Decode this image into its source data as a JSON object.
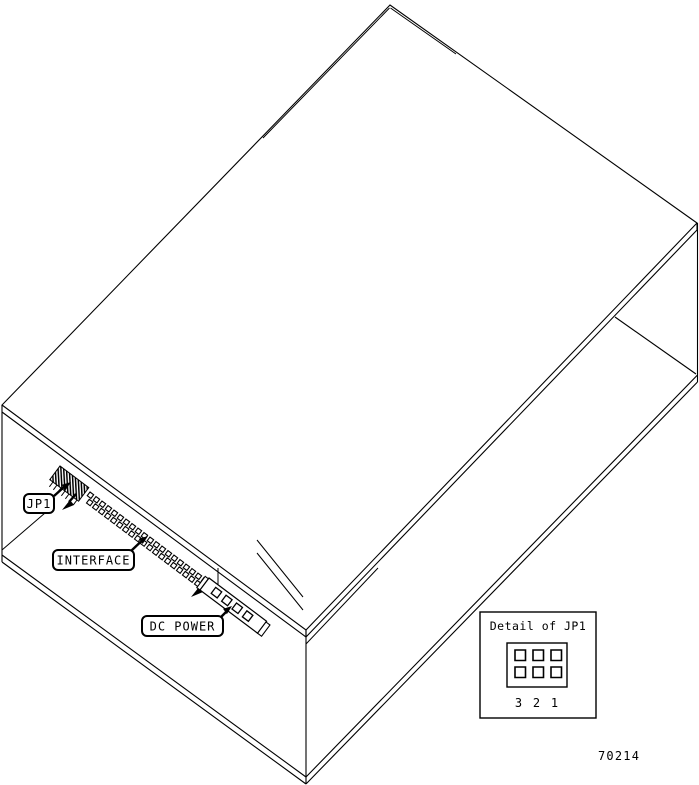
{
  "figure": {
    "callouts": [
      {
        "id": "jp1",
        "label": "JP1"
      },
      {
        "id": "interface",
        "label": "INTERFACE"
      },
      {
        "id": "dc_power",
        "label": "DC POWER"
      }
    ],
    "detail_box": {
      "title": "Detail of JP1",
      "pin_labels": [
        "3",
        "2",
        "1"
      ],
      "pin_rows": 2,
      "pin_cols": 3
    },
    "figure_number": "70214",
    "colors": {
      "line": "#000000",
      "background": "#ffffff"
    }
  }
}
